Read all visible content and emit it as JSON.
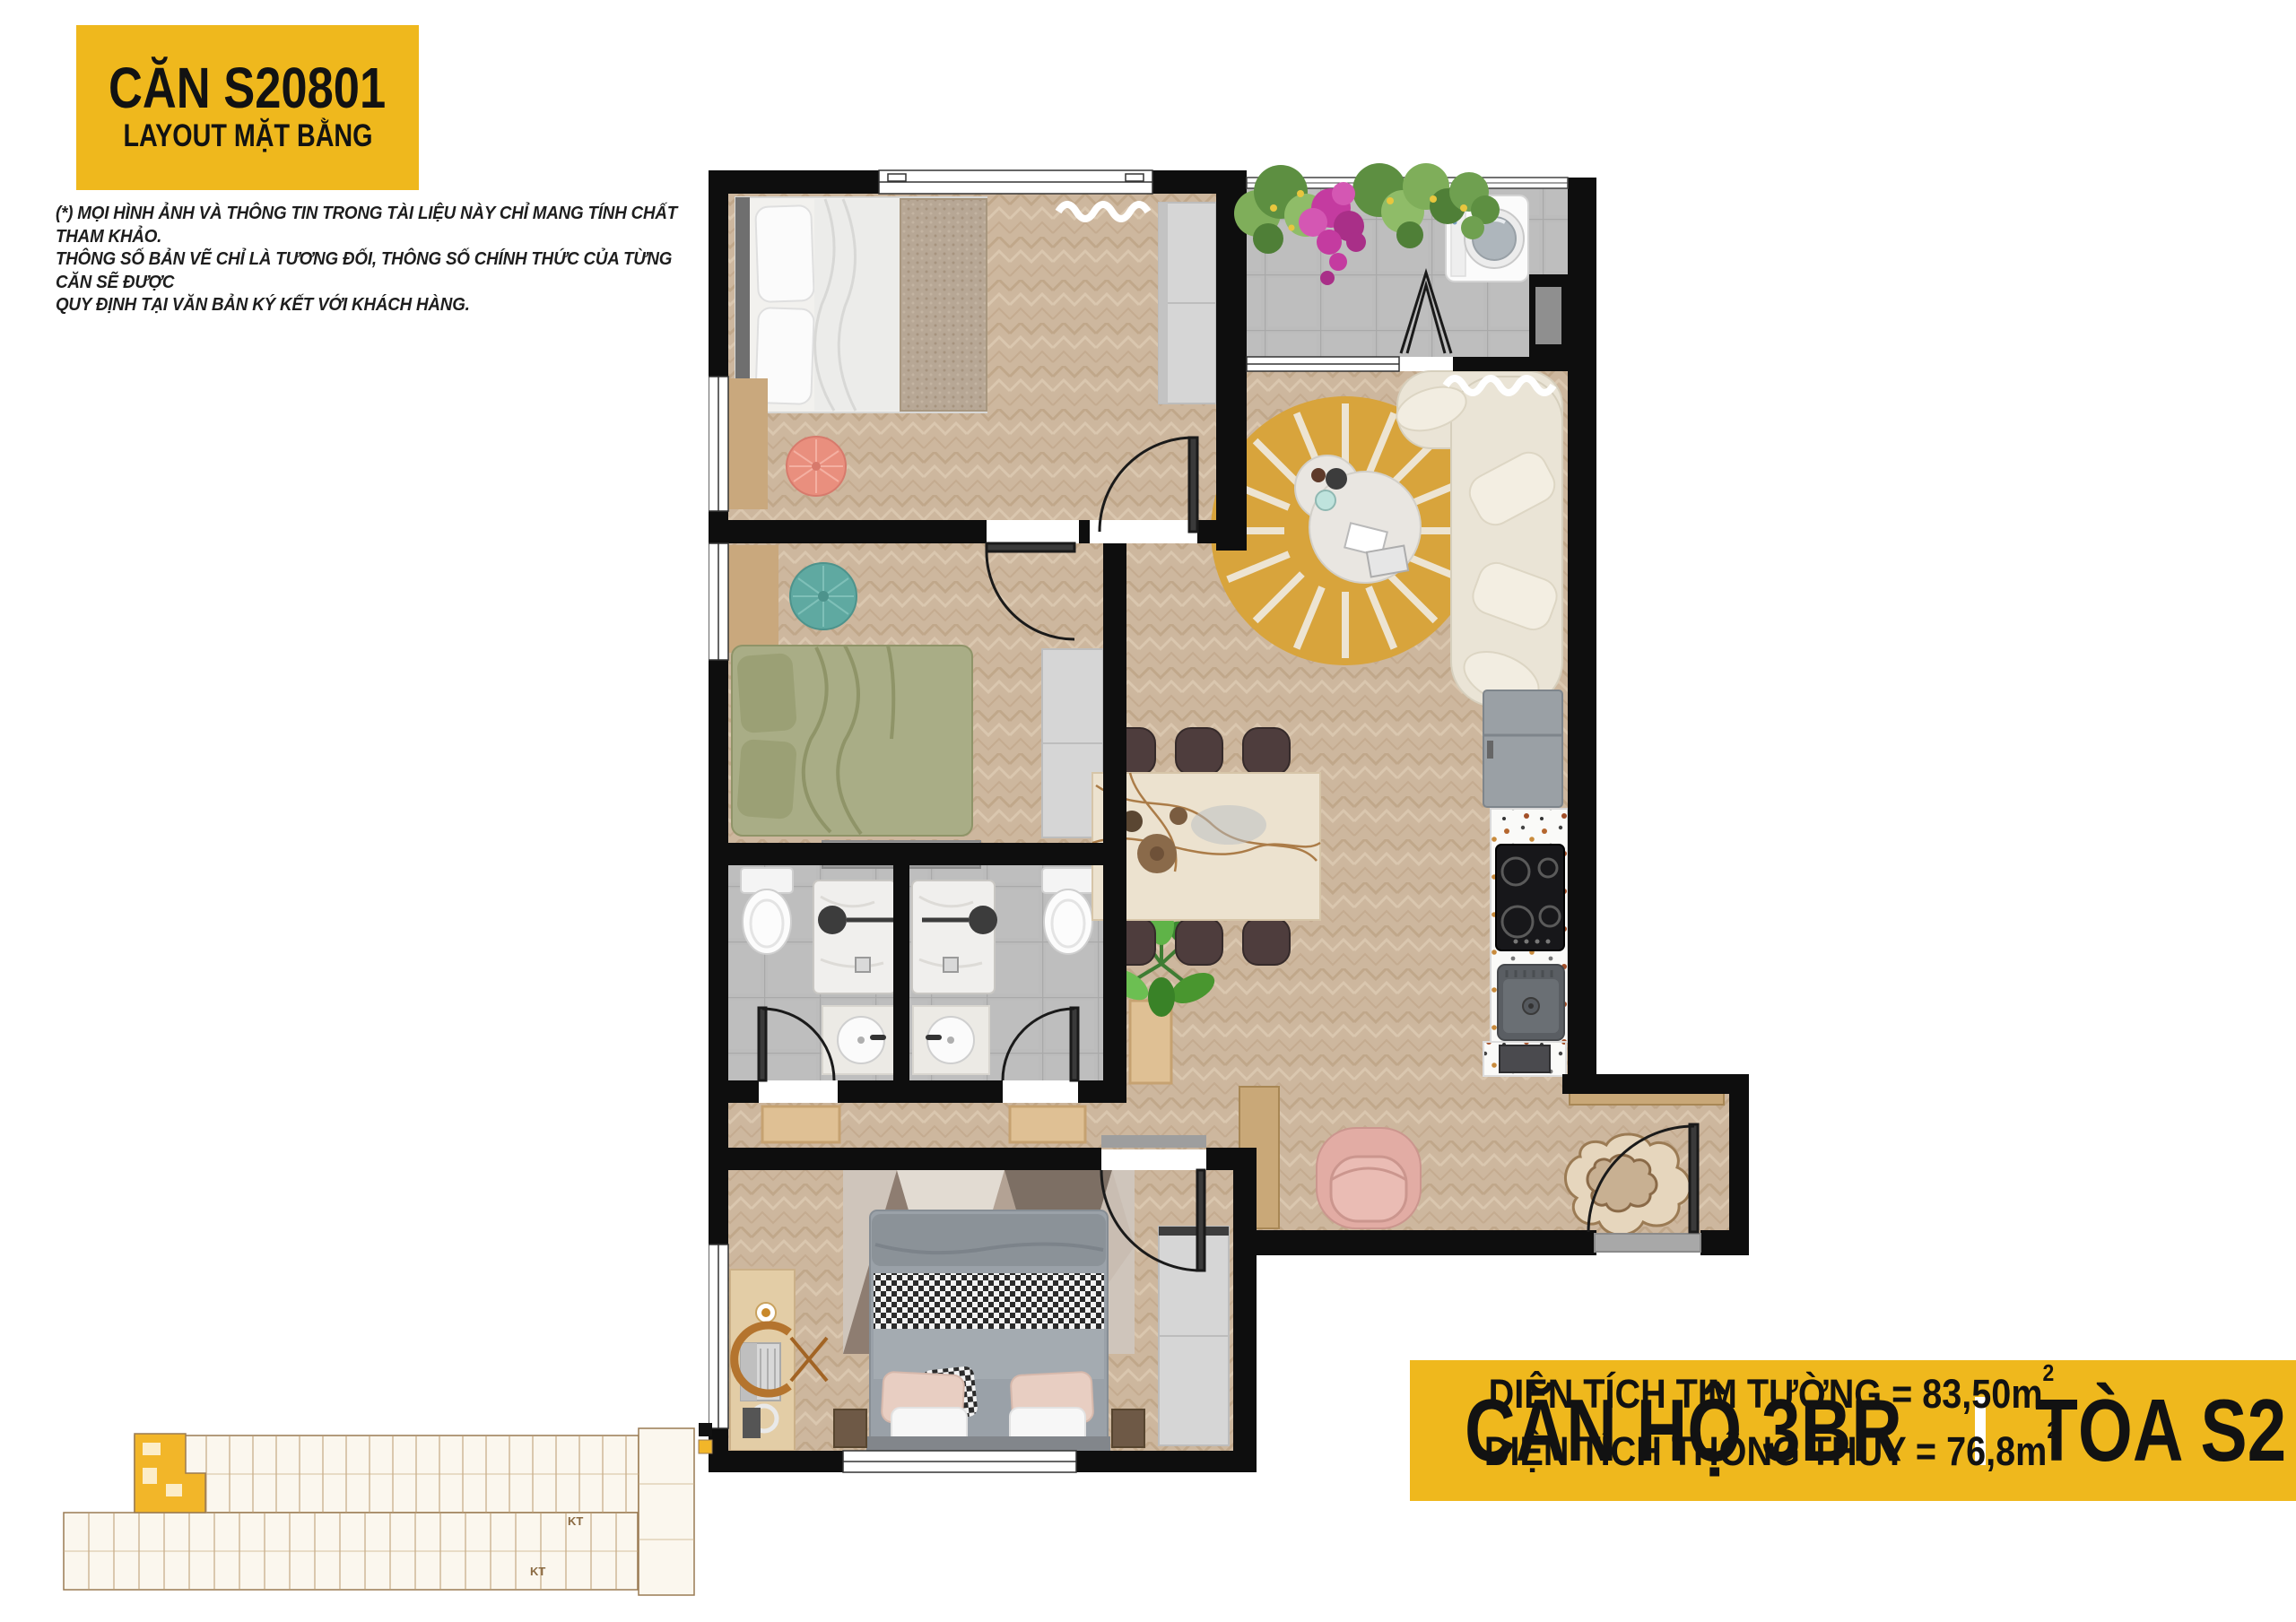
{
  "palette": {
    "accent": "#EFB81D",
    "ink": "#121212",
    "paper": "#ffffff",
    "wall": "#0E0E0E",
    "wood": "#CDB69E",
    "tile": "#BDBDBD",
    "yellow_rug": "#D8A43C",
    "sofa": "#EAE4D6",
    "bed_green": "#A9AD86",
    "pouf_teal": "#5FA9A1",
    "pouf_pink": "#E98F7E",
    "armchair_pink": "#E2ACA4"
  },
  "header": {
    "title": "CĂN S20801",
    "subtitle": "LAYOUT MẶT BẰNG"
  },
  "disclaimer": {
    "lines": [
      "(*) MỌI HÌNH ẢNH VÀ THÔNG TIN TRONG TÀI LIỆU NÀY CHỈ MANG TÍNH  CHẤT THAM KHẢO.",
      "THÔNG SỐ BẢN VẼ CHỈ LÀ TƯƠNG ĐỐI, THÔNG SỐ CHÍNH THỨC CỦA TỪNG CĂN SẼ ĐƯỢC",
      "QUY ĐỊNH TẠI VĂN BẢN KÝ KẾT VỚI KHÁCH HÀNG."
    ]
  },
  "unit_info": {
    "type_label": "CĂN HỘ 3BR",
    "tower_label": "TÒA S2",
    "area1_label": "DIỆN TÍCH TIM TƯỜNG = 83,50m",
    "area1_sup": "2",
    "area2_label": "DIỆN TÍCH THÔNG THỦY = 76,8m",
    "area2_sup": "2"
  },
  "keyplan": {
    "kt_upper": "KT",
    "kt_lower": "KT"
  }
}
